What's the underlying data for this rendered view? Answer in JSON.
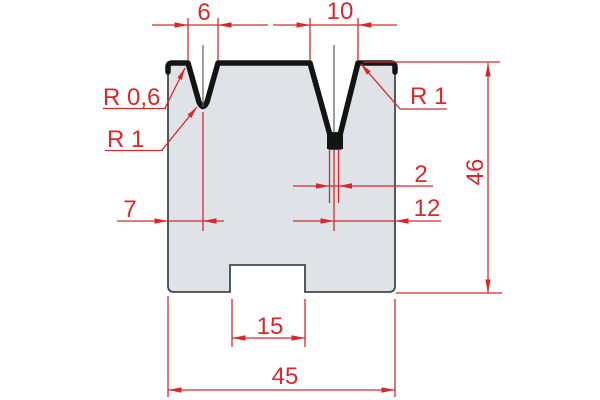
{
  "drawing": {
    "type": "technical-drawing",
    "subject": "2V press-brake die cross-section with dimensions",
    "units": "mm (decimal comma notation)",
    "colors": {
      "dimension_red": "#d42a2e",
      "outline_thick": "#141414",
      "outline_thin": "#46474b",
      "body_fill": "#dfe2e6",
      "centerline": "#5c5d61",
      "background": "#ffffff"
    },
    "labels": {
      "v1_opening": "6",
      "v2_opening": "10",
      "v1_shoulder_radius": "R 0,6",
      "v1_groove_radius": "R 1",
      "v2_shoulder_radius": "R 1",
      "total_height": "46",
      "v2_slot_width": "2",
      "v1_center_from_left_edge": "7",
      "v2_center_from_right_edge": "12",
      "base_notch_width": "15",
      "total_width": "45"
    }
  }
}
